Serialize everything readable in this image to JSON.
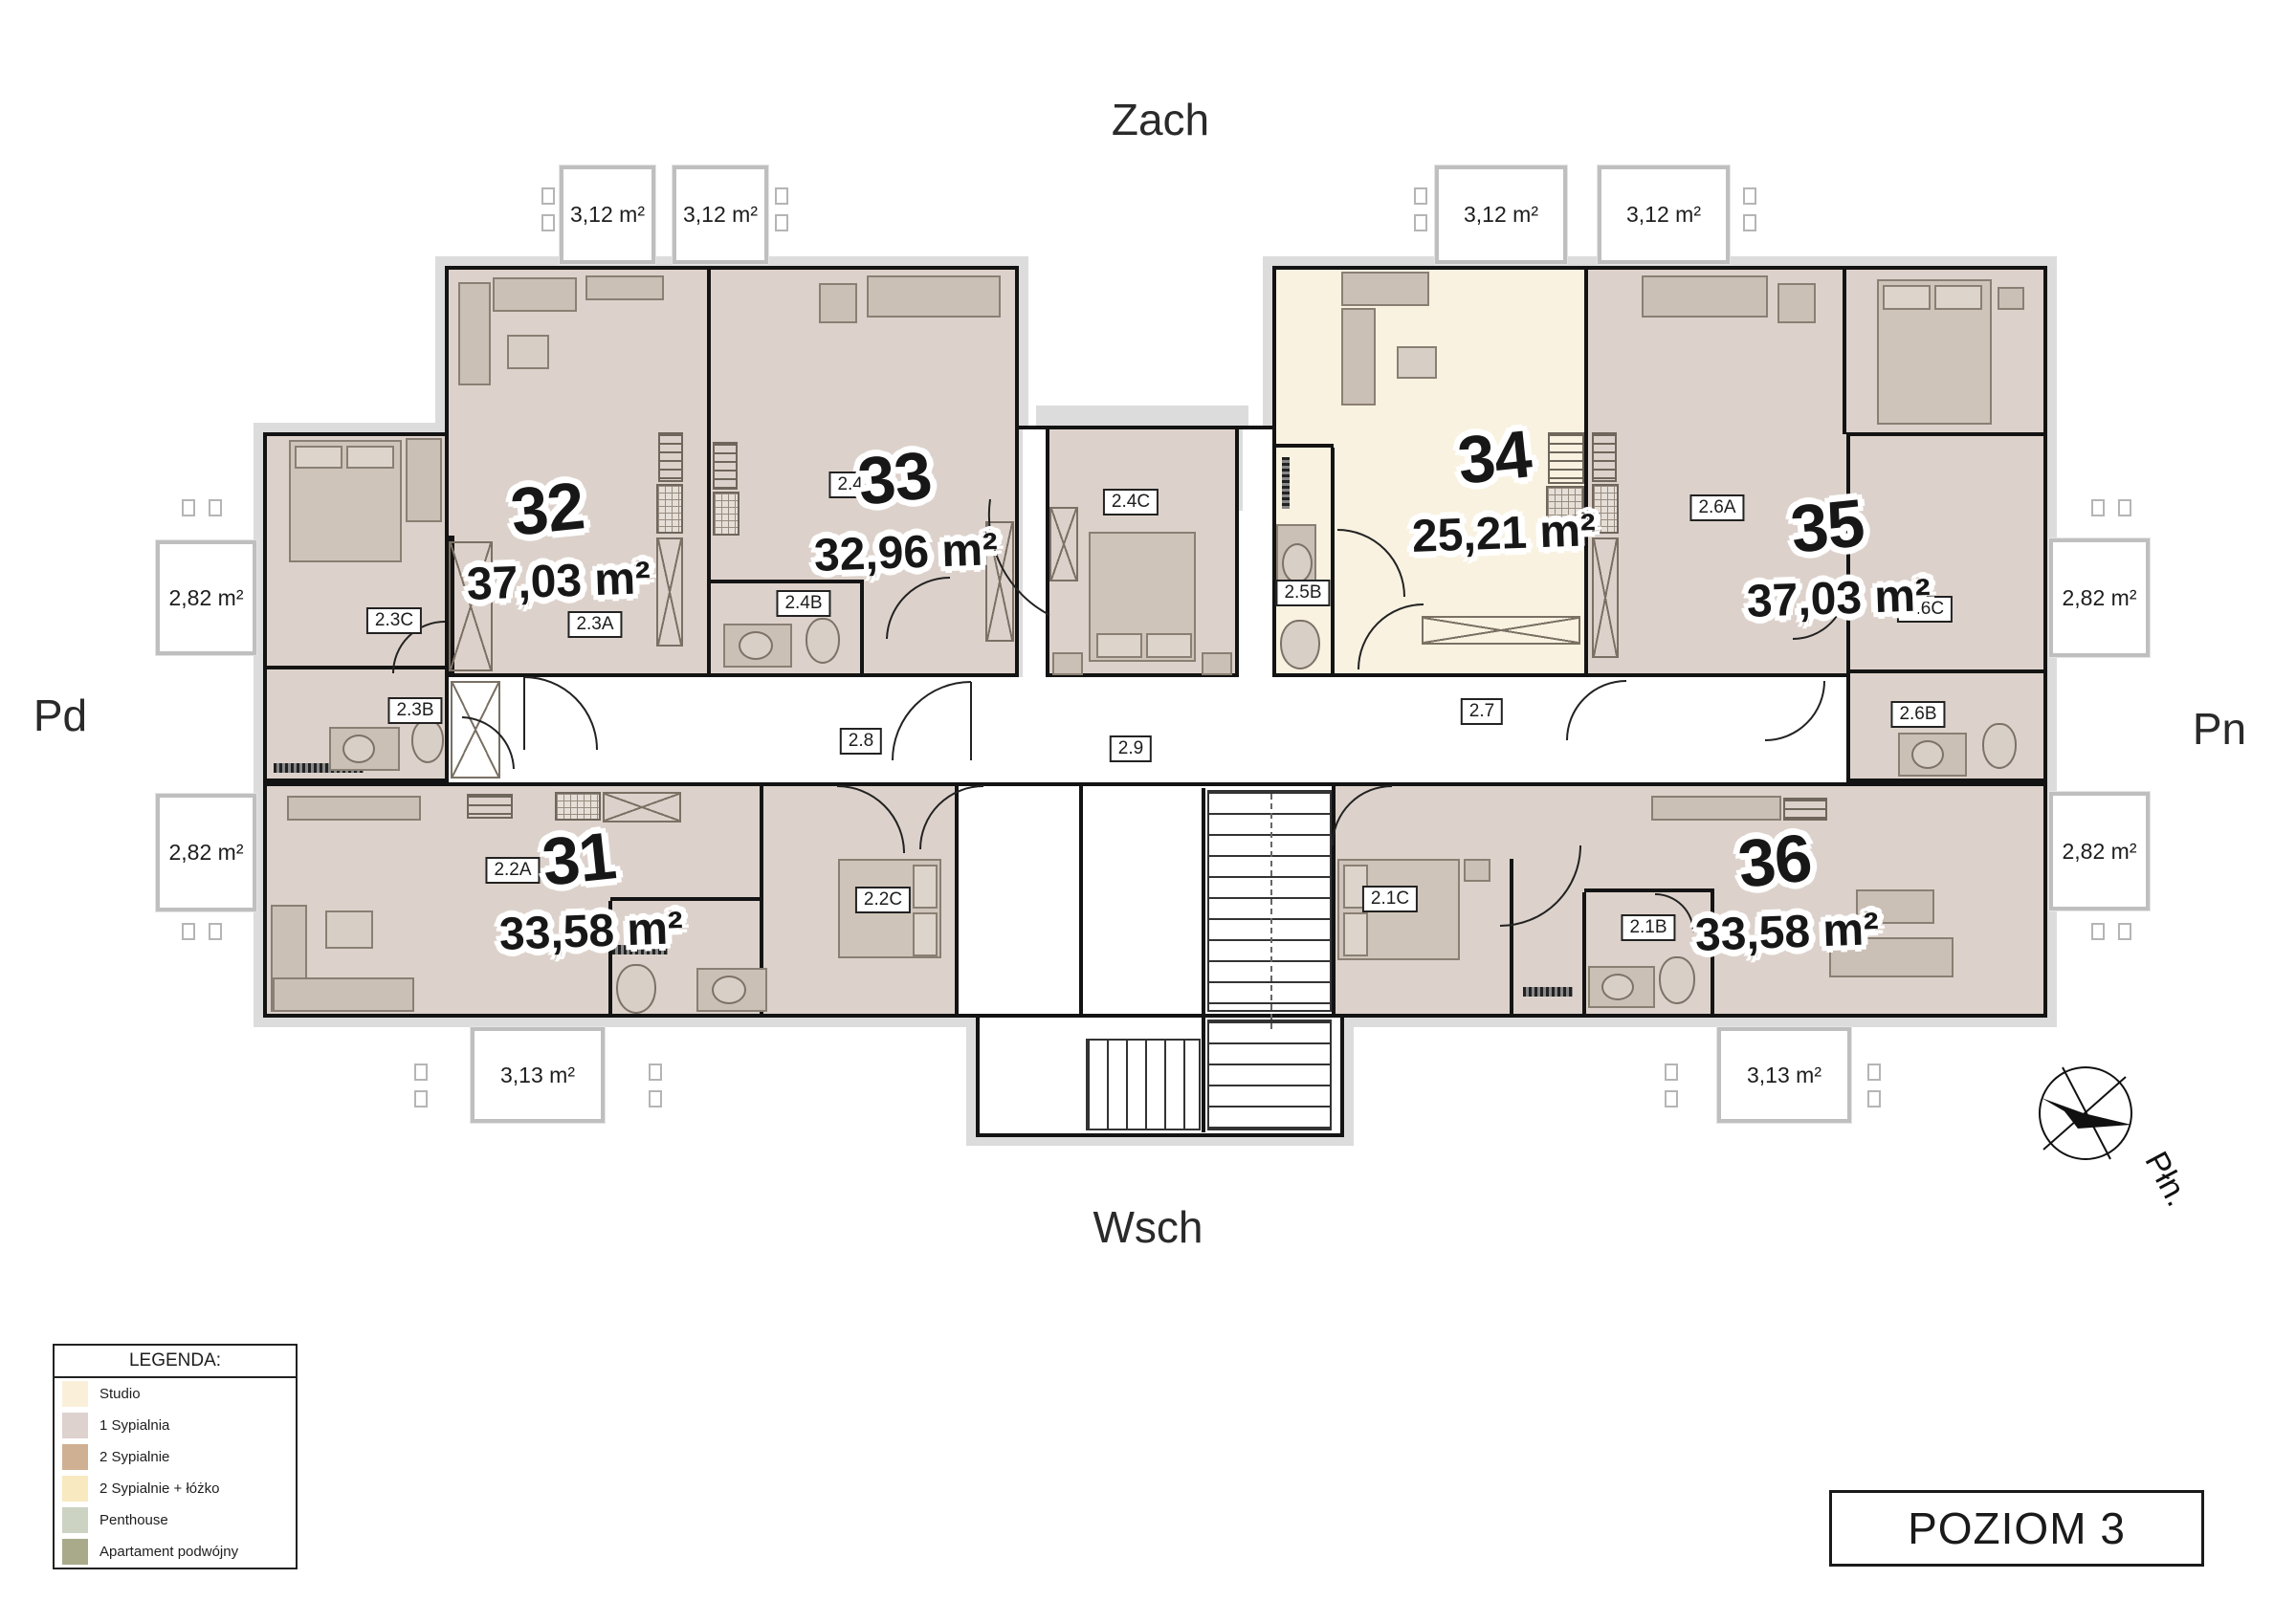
{
  "directions": {
    "top": "Zach",
    "bottom": "Wsch",
    "left": "Pd",
    "right": "Pn"
  },
  "compass": {
    "north_label": "Płn."
  },
  "level_badge": "POZIOM 3",
  "legend": {
    "title": "LEGENDA:",
    "items": [
      {
        "label": "Studio",
        "color": "#faf0da"
      },
      {
        "label": "1 Sypialnia",
        "color": "#ded2ce"
      },
      {
        "label": "2 Sypialnie",
        "color": "#d0b092"
      },
      {
        "label": "2 Sypialnie + łóżko",
        "color": "#f8e9c0"
      },
      {
        "label": "Penthouse",
        "color": "#ccd3c3"
      },
      {
        "label": "Apartament podwójny",
        "color": "#a9aa8a"
      }
    ]
  },
  "apartments": {
    "a31": {
      "number": "31",
      "area": "33,58 m²",
      "type": "1 Sypialnia"
    },
    "a32": {
      "number": "32",
      "area": "37,03 m²",
      "type": "1 Sypialnia"
    },
    "a33": {
      "number": "33",
      "area": "32,96 m²",
      "type": "1 Sypialnia"
    },
    "a34": {
      "number": "34",
      "area": "25,21 m²",
      "type": "Studio"
    },
    "a35": {
      "number": "35",
      "area": "37,03 m²",
      "type": "1 Sypialnia"
    },
    "a36": {
      "number": "36",
      "area": "33,58 m²",
      "type": "1 Sypialnia"
    }
  },
  "room_labels": {
    "k2_1B": "2.1B",
    "k2_1C": "2.1C",
    "k2_2A": "2.2A",
    "k2_2C": "2.2C",
    "k2_3A": "2.3A",
    "k2_3B": "2.3B",
    "k2_3C": "2.3C",
    "k2_4A": "2.4A",
    "k2_4B": "2.4B",
    "k2_4C": "2.4C",
    "k2_5B": "2.5B",
    "k2_6A": "2.6A",
    "k2_6B": "2.6B",
    "k2_6C": "2.6C",
    "k2_7": "2.7",
    "k2_8": "2.8",
    "k2_9": "2.9"
  },
  "balconies": {
    "top": [
      "3,12 m²",
      "3,12 m²",
      "3,12 m²",
      "3,12 m²"
    ],
    "sides": [
      "2,82 m²",
      "2,82 m²",
      "2,82 m²",
      "2,82 m²"
    ],
    "bottom": [
      "3,13 m²",
      "3,13 m²"
    ]
  },
  "colors": {
    "one_bedroom_fill": "#ddd2cb",
    "studio_fill": "#f9f2e0"
  }
}
